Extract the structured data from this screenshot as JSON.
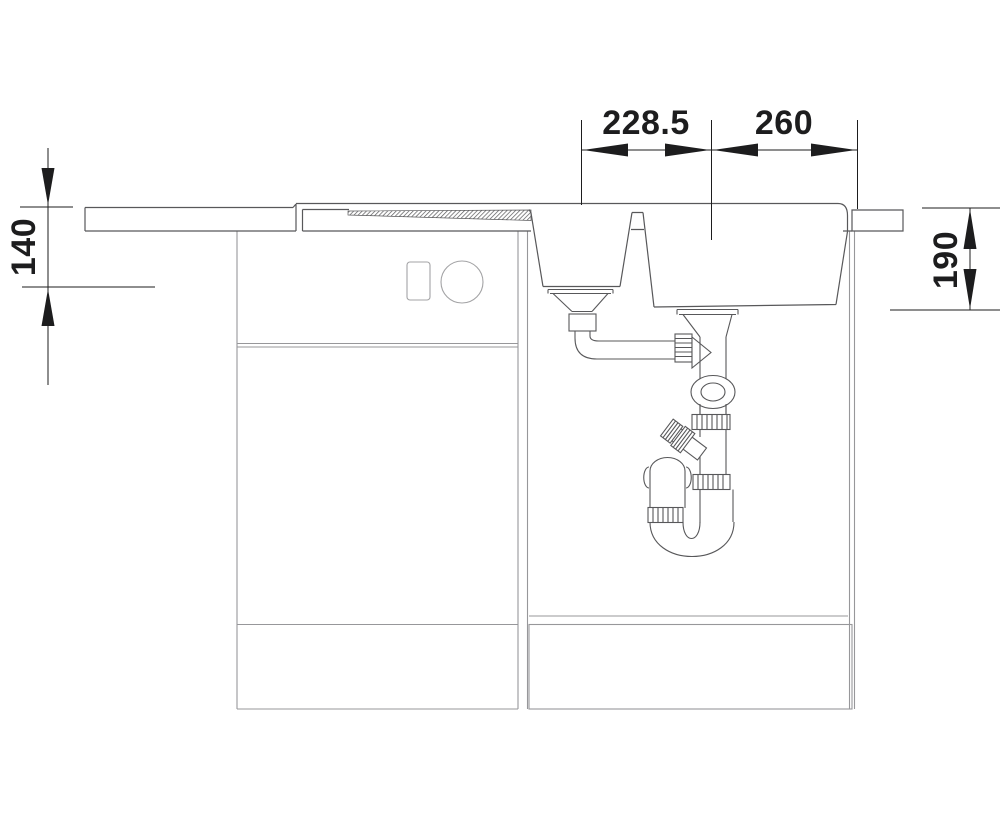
{
  "drawing": {
    "title": "sink-installation-side-view",
    "dimensions": {
      "top_left": "228.5",
      "top_right": "260",
      "left": "140",
      "right": "190"
    },
    "colors": {
      "outline": "#58585a",
      "cabinet": "#97979a",
      "knob": "#a3a3a5",
      "annotation": "#1d1d1e",
      "background": "#ffffff"
    }
  }
}
